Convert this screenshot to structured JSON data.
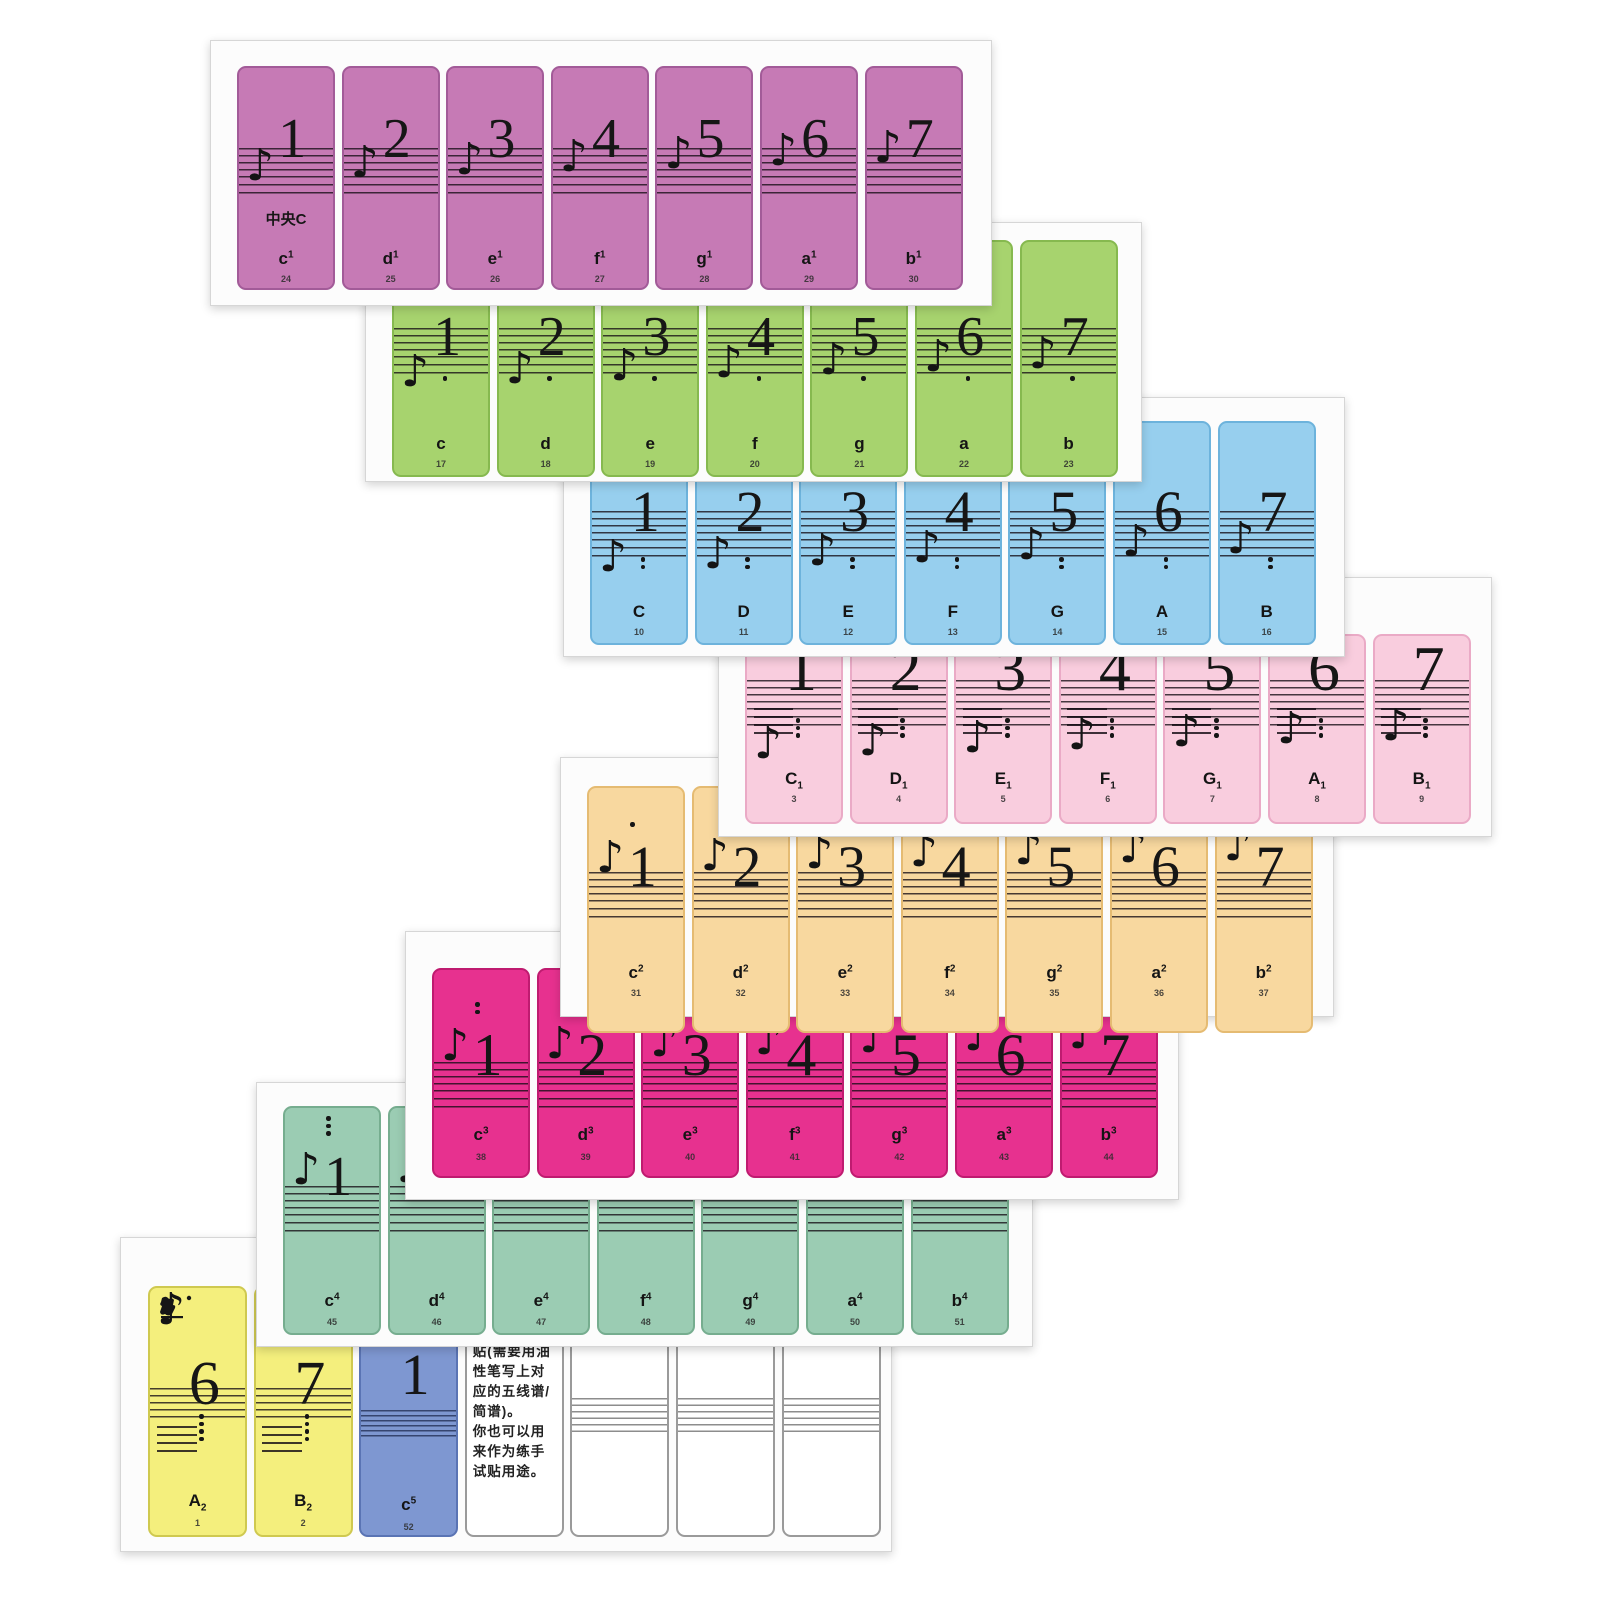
{
  "product_title": "Piano keyboard numbered-notation key sticker sheets",
  "colors": {
    "page_bg": "#ffffff",
    "sheet_bg": "#fcfcfc",
    "sheet_border": "#d6d6d6",
    "ink": "#161616"
  },
  "middle_c_label": "中央C",
  "instruction_text": "贴(需要用油性笔写上对应的五线谱/简谱)。\n你也可以用来作为练手试贴用途。",
  "sheets": [
    {
      "id": "one-line-octave",
      "fill": "#c67ab5",
      "border": "#a25b98",
      "octave_dots": {
        "count": 0,
        "position": "none"
      },
      "stickers": [
        {
          "num": "1",
          "name": "c",
          "mark": "1",
          "mark_pos": "sup",
          "idx": "24",
          "middle_c": true
        },
        {
          "num": "2",
          "name": "d",
          "mark": "1",
          "mark_pos": "sup",
          "idx": "25"
        },
        {
          "num": "3",
          "name": "e",
          "mark": "1",
          "mark_pos": "sup",
          "idx": "26"
        },
        {
          "num": "4",
          "name": "f",
          "mark": "1",
          "mark_pos": "sup",
          "idx": "27"
        },
        {
          "num": "5",
          "name": "g",
          "mark": "1",
          "mark_pos": "sup",
          "idx": "28"
        },
        {
          "num": "6",
          "name": "a",
          "mark": "1",
          "mark_pos": "sup",
          "idx": "29"
        },
        {
          "num": "7",
          "name": "b",
          "mark": "1",
          "mark_pos": "sup",
          "idx": "30"
        }
      ]
    },
    {
      "id": "small-octave",
      "fill": "#a7d36e",
      "border": "#86b94f",
      "octave_dots": {
        "count": 1,
        "position": "below"
      },
      "stickers": [
        {
          "num": "1",
          "name": "c",
          "mark": "",
          "mark_pos": "none",
          "idx": "17"
        },
        {
          "num": "2",
          "name": "d",
          "mark": "",
          "mark_pos": "none",
          "idx": "18"
        },
        {
          "num": "3",
          "name": "e",
          "mark": "",
          "mark_pos": "none",
          "idx": "19"
        },
        {
          "num": "4",
          "name": "f",
          "mark": "",
          "mark_pos": "none",
          "idx": "20"
        },
        {
          "num": "5",
          "name": "g",
          "mark": "",
          "mark_pos": "none",
          "idx": "21"
        },
        {
          "num": "6",
          "name": "a",
          "mark": "",
          "mark_pos": "none",
          "idx": "22"
        },
        {
          "num": "7",
          "name": "b",
          "mark": "",
          "mark_pos": "none",
          "idx": "23"
        }
      ]
    },
    {
      "id": "great-octave",
      "fill": "#97cfee",
      "border": "#6db3dc",
      "octave_dots": {
        "count": 2,
        "position": "below"
      },
      "stickers": [
        {
          "num": "1",
          "name": "C",
          "mark": "",
          "mark_pos": "none",
          "idx": "10"
        },
        {
          "num": "2",
          "name": "D",
          "mark": "",
          "mark_pos": "none",
          "idx": "11"
        },
        {
          "num": "3",
          "name": "E",
          "mark": "",
          "mark_pos": "none",
          "idx": "12"
        },
        {
          "num": "4",
          "name": "F",
          "mark": "",
          "mark_pos": "none",
          "idx": "13"
        },
        {
          "num": "5",
          "name": "G",
          "mark": "",
          "mark_pos": "none",
          "idx": "14"
        },
        {
          "num": "6",
          "name": "A",
          "mark": "",
          "mark_pos": "none",
          "idx": "15"
        },
        {
          "num": "7",
          "name": "B",
          "mark": "",
          "mark_pos": "none",
          "idx": "16"
        }
      ]
    },
    {
      "id": "contra-octave",
      "fill": "#f9cdde",
      "border": "#eaaac6",
      "octave_dots": {
        "count": 3,
        "position": "below"
      },
      "stickers": [
        {
          "num": "1",
          "name": "C",
          "mark": "1",
          "mark_pos": "sub",
          "idx": "3"
        },
        {
          "num": "2",
          "name": "D",
          "mark": "1",
          "mark_pos": "sub",
          "idx": "4"
        },
        {
          "num": "3",
          "name": "E",
          "mark": "1",
          "mark_pos": "sub",
          "idx": "5"
        },
        {
          "num": "4",
          "name": "F",
          "mark": "1",
          "mark_pos": "sub",
          "idx": "6"
        },
        {
          "num": "5",
          "name": "G",
          "mark": "1",
          "mark_pos": "sub",
          "idx": "7"
        },
        {
          "num": "6",
          "name": "A",
          "mark": "1",
          "mark_pos": "sub",
          "idx": "8"
        },
        {
          "num": "7",
          "name": "B",
          "mark": "1",
          "mark_pos": "sub",
          "idx": "9"
        }
      ]
    },
    {
      "id": "two-line-octave",
      "fill": "#f8d89f",
      "border": "#e5bb72",
      "octave_dots": {
        "count": 1,
        "position": "above"
      },
      "stickers": [
        {
          "num": "1",
          "name": "c",
          "mark": "2",
          "mark_pos": "sup",
          "idx": "31"
        },
        {
          "num": "2",
          "name": "d",
          "mark": "2",
          "mark_pos": "sup",
          "idx": "32"
        },
        {
          "num": "3",
          "name": "e",
          "mark": "2",
          "mark_pos": "sup",
          "idx": "33"
        },
        {
          "num": "4",
          "name": "f",
          "mark": "2",
          "mark_pos": "sup",
          "idx": "34"
        },
        {
          "num": "5",
          "name": "g",
          "mark": "2",
          "mark_pos": "sup",
          "idx": "35"
        },
        {
          "num": "6",
          "name": "a",
          "mark": "2",
          "mark_pos": "sup",
          "idx": "36"
        },
        {
          "num": "7",
          "name": "b",
          "mark": "2",
          "mark_pos": "sup",
          "idx": "37"
        }
      ]
    },
    {
      "id": "three-line-octave",
      "fill": "#e7318f",
      "border": "#bf1b70",
      "octave_dots": {
        "count": 2,
        "position": "above"
      },
      "stickers": [
        {
          "num": "1",
          "name": "c",
          "mark": "3",
          "mark_pos": "sup",
          "idx": "38"
        },
        {
          "num": "2",
          "name": "d",
          "mark": "3",
          "mark_pos": "sup",
          "idx": "39"
        },
        {
          "num": "3",
          "name": "e",
          "mark": "3",
          "mark_pos": "sup",
          "idx": "40"
        },
        {
          "num": "4",
          "name": "f",
          "mark": "3",
          "mark_pos": "sup",
          "idx": "41"
        },
        {
          "num": "5",
          "name": "g",
          "mark": "3",
          "mark_pos": "sup",
          "idx": "42"
        },
        {
          "num": "6",
          "name": "a",
          "mark": "3",
          "mark_pos": "sup",
          "idx": "43"
        },
        {
          "num": "7",
          "name": "b",
          "mark": "3",
          "mark_pos": "sup",
          "idx": "44"
        }
      ]
    },
    {
      "id": "four-line-octave",
      "fill": "#9bccb3",
      "border": "#76ad8f",
      "octave_dots": {
        "count": 3,
        "position": "above"
      },
      "octava_label": "8",
      "stickers": [
        {
          "num": "1",
          "name": "c",
          "mark": "4",
          "mark_pos": "sup",
          "idx": "45"
        },
        {
          "num": "2",
          "name": "d",
          "mark": "4",
          "mark_pos": "sup",
          "idx": "46"
        },
        {
          "num": "3",
          "name": "e",
          "mark": "4",
          "mark_pos": "sup",
          "idx": "47"
        },
        {
          "num": "4",
          "name": "f",
          "mark": "4",
          "mark_pos": "sup",
          "idx": "48"
        },
        {
          "num": "5",
          "name": "g",
          "mark": "4",
          "mark_pos": "sup",
          "idx": "49"
        },
        {
          "num": "6",
          "name": "a",
          "mark": "4",
          "mark_pos": "sup",
          "idx": "50"
        },
        {
          "num": "7",
          "name": "b",
          "mark": "4",
          "mark_pos": "sup",
          "idx": "51"
        }
      ]
    },
    {
      "id": "edge-sheet",
      "stickers": [
        {
          "type": "note",
          "variant": "yellow",
          "fill": "#f4ef7d",
          "border": "#cfc950",
          "num": "6",
          "name": "A",
          "mark": "2",
          "mark_pos": "sub",
          "idx": "1",
          "dots": {
            "count": 4,
            "position": "below"
          },
          "logo": true
        },
        {
          "type": "note",
          "variant": "yellow",
          "fill": "#f4ef7d",
          "border": "#cfc950",
          "num": "7",
          "name": "B",
          "mark": "2",
          "mark_pos": "sub",
          "idx": "2",
          "dots": {
            "count": 4,
            "position": "below"
          }
        },
        {
          "type": "note",
          "variant": "cblue",
          "fill": "#7e97d1",
          "border": "#5a74b4",
          "num": "1",
          "name": "c",
          "mark": "5",
          "mark_pos": "sup",
          "idx": "52",
          "dots": {
            "count": 0,
            "position": "none"
          }
        },
        {
          "type": "text",
          "fill": "#ffffff",
          "border": "#9a9a9a"
        },
        {
          "type": "blank",
          "fill": "#ffffff",
          "border": "#9a9a9a"
        },
        {
          "type": "blank",
          "fill": "#ffffff",
          "border": "#9a9a9a"
        },
        {
          "type": "blank",
          "fill": "#ffffff",
          "border": "#9a9a9a"
        }
      ]
    }
  ]
}
